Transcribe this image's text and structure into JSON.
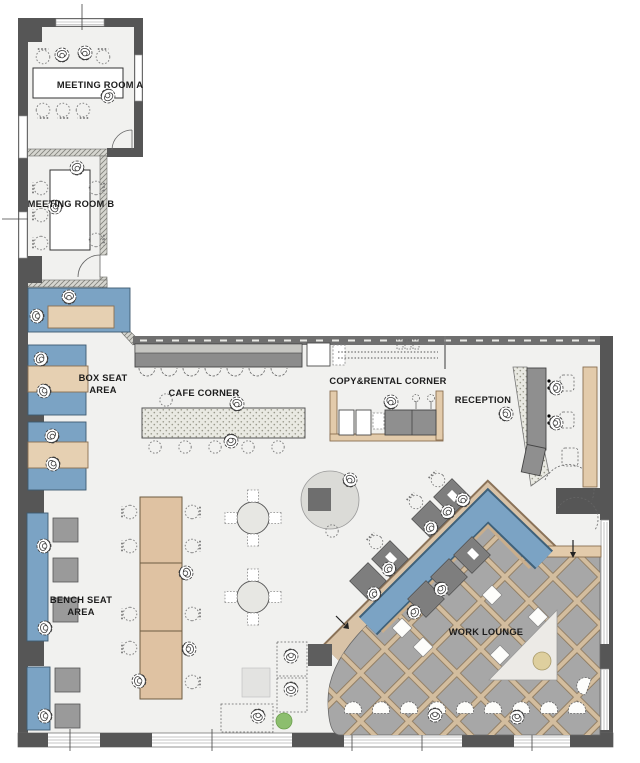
{
  "plan": {
    "labels": {
      "meeting_room_a": "MEETING ROOM A",
      "meeting_room_b": "MEETING ROOM B",
      "box_seat_line1": "BOX SEAT",
      "box_seat_line2": "AREA",
      "cafe_corner": "CAFE CORNER",
      "copy_rental_corner": "COPY&RENTAL CORNER",
      "reception": "RECEPTION",
      "bench_seat_line1": "BENCH SEAT",
      "bench_seat_line2": "AREA",
      "work_lounge": "WORK LOUNGE"
    },
    "colors": {
      "floor": "#f1f1ef",
      "wall": "#565656",
      "seat_blue": "#7ba3c4",
      "table_tan": "#e3cbab",
      "counter_gray": "#8c8c8c",
      "lounge_floor": "#a7a7a7",
      "lattice_line": "#d3bd9e",
      "desk_gray": "#7e7e7e",
      "plant_green": "#8cbe6e",
      "triangle_dot": "#decf9e",
      "text": "#1c1c1c"
    }
  }
}
